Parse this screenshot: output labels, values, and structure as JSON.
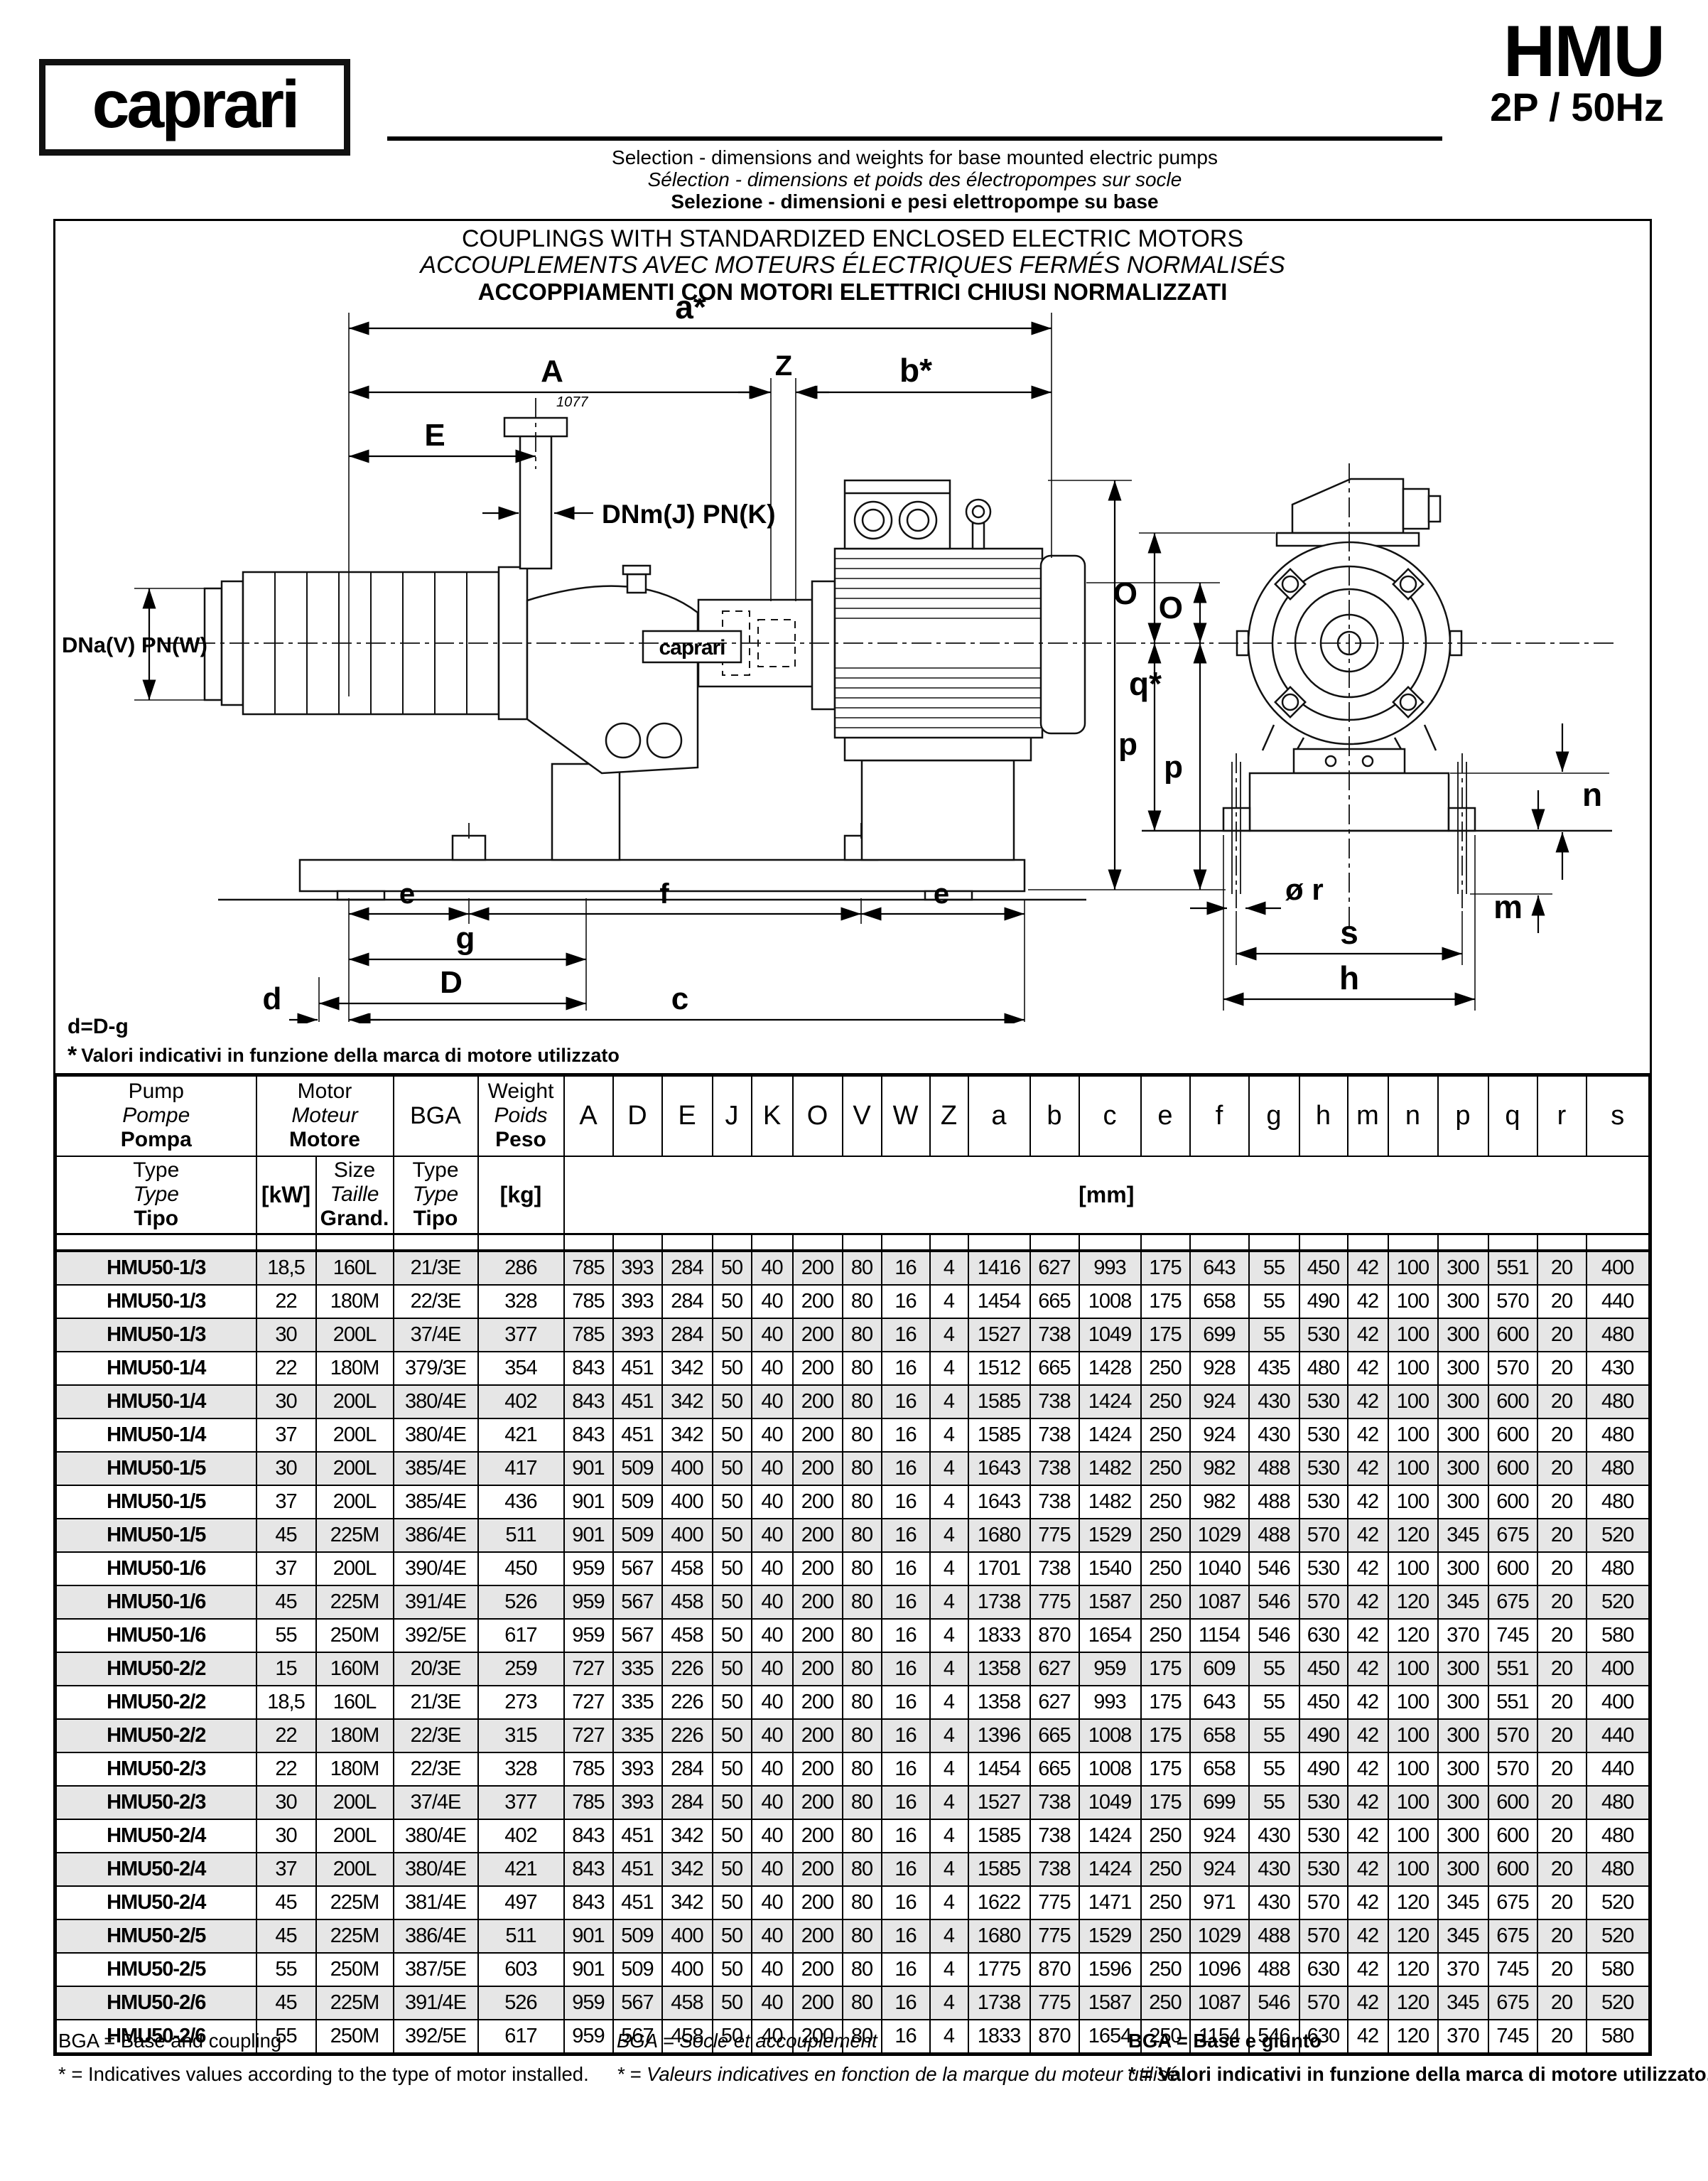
{
  "header": {
    "logo": "caprari",
    "title": "HMU",
    "subtitle": "2P / 50Hz",
    "line_en": "Selection - dimensions and weights for base mounted electric pumps",
    "line_fr": "Sélection - dimensions et poids des électropompes sur socle",
    "line_it": "Selezione - dimensioni e pesi elettropompe su base"
  },
  "box_titles": {
    "en": "COUPLINGS WITH STANDARDIZED ENCLOSED ELECTRIC MOTORS",
    "fr": "ACCOUPLEMENTS AVEC MOTEURS ÉLECTRIQUES FERMÉS NORMALISÉS",
    "it": "ACCOPPIAMENTI CON MOTORI ELETTRICI CHIUSI NORMALIZZATI"
  },
  "drawing": {
    "labels": {
      "a_star": "a*",
      "A": "A",
      "Z": "Z",
      "b_star": "b*",
      "E": "E",
      "dnm": "DNm(J) PN(K)",
      "dna": "DNa(V) PN(W)",
      "q_star": "q*",
      "O_side": "O",
      "p_side": "p",
      "e1": "e",
      "f": "f",
      "e2": "e",
      "g": "g",
      "D": "D",
      "d": "d",
      "c": "c",
      "O_end": "O",
      "p_end": "p",
      "n": "n",
      "m": "m",
      "r": "ø r",
      "s": "s",
      "h": "h",
      "brand": "caprari",
      "serial": "1077"
    },
    "notes": {
      "formula": "d=D-g",
      "star": "*",
      "note_it": "Valori indicativi in funzione della marca di motore utilizzato",
      "note_en": "Indicative values according to the type of motor installed"
    }
  },
  "table": {
    "header": {
      "pump": [
        "Pump",
        "Pompe",
        "Pompa"
      ],
      "motor": [
        "Motor",
        "Moteur",
        "Motore"
      ],
      "bga": "BGA",
      "weight": [
        "Weight",
        "Poids",
        "Peso"
      ],
      "pump_sub": [
        "Type",
        "Type",
        "Tipo"
      ],
      "kw": "[kW]",
      "size_sub": [
        "Size",
        "Taille",
        "Grand."
      ],
      "bga_sub": [
        "Type",
        "Type",
        "Tipo"
      ],
      "kg": "[kg]",
      "mm": "[mm]",
      "dim_cols": [
        "A",
        "D",
        "E",
        "J",
        "K",
        "O",
        "V",
        "W",
        "Z",
        "a",
        "b",
        "c",
        "e",
        "f",
        "g",
        "h",
        "m",
        "n",
        "p",
        "q",
        "r",
        "s"
      ]
    },
    "rows": [
      {
        "type": "HMU50-1/3",
        "kw": "18,5",
        "size": "160L",
        "bga": "21/3E",
        "kg": "286",
        "dims": [
          785,
          393,
          284,
          50,
          40,
          200,
          80,
          16,
          4,
          1416,
          627,
          993,
          175,
          643,
          55,
          450,
          42,
          100,
          300,
          551,
          20,
          400
        ]
      },
      {
        "type": "HMU50-1/3",
        "kw": "22",
        "size": "180M",
        "bga": "22/3E",
        "kg": "328",
        "dims": [
          785,
          393,
          284,
          50,
          40,
          200,
          80,
          16,
          4,
          1454,
          665,
          1008,
          175,
          658,
          55,
          490,
          42,
          100,
          300,
          570,
          20,
          440
        ]
      },
      {
        "type": "HMU50-1/3",
        "kw": "30",
        "size": "200L",
        "bga": "37/4E",
        "kg": "377",
        "dims": [
          785,
          393,
          284,
          50,
          40,
          200,
          80,
          16,
          4,
          1527,
          738,
          1049,
          175,
          699,
          55,
          530,
          42,
          100,
          300,
          600,
          20,
          480
        ]
      },
      {
        "type": "HMU50-1/4",
        "kw": "22",
        "size": "180M",
        "bga": "379/3E",
        "kg": "354",
        "dims": [
          843,
          451,
          342,
          50,
          40,
          200,
          80,
          16,
          4,
          1512,
          665,
          1428,
          250,
          928,
          435,
          480,
          42,
          100,
          300,
          570,
          20,
          430
        ]
      },
      {
        "type": "HMU50-1/4",
        "kw": "30",
        "size": "200L",
        "bga": "380/4E",
        "kg": "402",
        "dims": [
          843,
          451,
          342,
          50,
          40,
          200,
          80,
          16,
          4,
          1585,
          738,
          1424,
          250,
          924,
          430,
          530,
          42,
          100,
          300,
          600,
          20,
          480
        ]
      },
      {
        "type": "HMU50-1/4",
        "kw": "37",
        "size": "200L",
        "bga": "380/4E",
        "kg": "421",
        "dims": [
          843,
          451,
          342,
          50,
          40,
          200,
          80,
          16,
          4,
          1585,
          738,
          1424,
          250,
          924,
          430,
          530,
          42,
          100,
          300,
          600,
          20,
          480
        ]
      },
      {
        "type": "HMU50-1/5",
        "kw": "30",
        "size": "200L",
        "bga": "385/4E",
        "kg": "417",
        "dims": [
          901,
          509,
          400,
          50,
          40,
          200,
          80,
          16,
          4,
          1643,
          738,
          1482,
          250,
          982,
          488,
          530,
          42,
          100,
          300,
          600,
          20,
          480
        ]
      },
      {
        "type": "HMU50-1/5",
        "kw": "37",
        "size": "200L",
        "bga": "385/4E",
        "kg": "436",
        "dims": [
          901,
          509,
          400,
          50,
          40,
          200,
          80,
          16,
          4,
          1643,
          738,
          1482,
          250,
          982,
          488,
          530,
          42,
          100,
          300,
          600,
          20,
          480
        ]
      },
      {
        "type": "HMU50-1/5",
        "kw": "45",
        "size": "225M",
        "bga": "386/4E",
        "kg": "511",
        "dims": [
          901,
          509,
          400,
          50,
          40,
          200,
          80,
          16,
          4,
          1680,
          775,
          1529,
          250,
          1029,
          488,
          570,
          42,
          120,
          345,
          675,
          20,
          520
        ]
      },
      {
        "type": "HMU50-1/6",
        "kw": "37",
        "size": "200L",
        "bga": "390/4E",
        "kg": "450",
        "dims": [
          959,
          567,
          458,
          50,
          40,
          200,
          80,
          16,
          4,
          1701,
          738,
          1540,
          250,
          1040,
          546,
          530,
          42,
          100,
          300,
          600,
          20,
          480
        ]
      },
      {
        "type": "HMU50-1/6",
        "kw": "45",
        "size": "225M",
        "bga": "391/4E",
        "kg": "526",
        "dims": [
          959,
          567,
          458,
          50,
          40,
          200,
          80,
          16,
          4,
          1738,
          775,
          1587,
          250,
          1087,
          546,
          570,
          42,
          120,
          345,
          675,
          20,
          520
        ]
      },
      {
        "type": "HMU50-1/6",
        "kw": "55",
        "size": "250M",
        "bga": "392/5E",
        "kg": "617",
        "dims": [
          959,
          567,
          458,
          50,
          40,
          200,
          80,
          16,
          4,
          1833,
          870,
          1654,
          250,
          1154,
          546,
          630,
          42,
          120,
          370,
          745,
          20,
          580
        ]
      },
      {
        "type": "HMU50-2/2",
        "kw": "15",
        "size": "160M",
        "bga": "20/3E",
        "kg": "259",
        "dims": [
          727,
          335,
          226,
          50,
          40,
          200,
          80,
          16,
          4,
          1358,
          627,
          959,
          175,
          609,
          55,
          450,
          42,
          100,
          300,
          551,
          20,
          400
        ]
      },
      {
        "type": "HMU50-2/2",
        "kw": "18,5",
        "size": "160L",
        "bga": "21/3E",
        "kg": "273",
        "dims": [
          727,
          335,
          226,
          50,
          40,
          200,
          80,
          16,
          4,
          1358,
          627,
          993,
          175,
          643,
          55,
          450,
          42,
          100,
          300,
          551,
          20,
          400
        ]
      },
      {
        "type": "HMU50-2/2",
        "kw": "22",
        "size": "180M",
        "bga": "22/3E",
        "kg": "315",
        "dims": [
          727,
          335,
          226,
          50,
          40,
          200,
          80,
          16,
          4,
          1396,
          665,
          1008,
          175,
          658,
          55,
          490,
          42,
          100,
          300,
          570,
          20,
          440
        ]
      },
      {
        "type": "HMU50-2/3",
        "kw": "22",
        "size": "180M",
        "bga": "22/3E",
        "kg": "328",
        "dims": [
          785,
          393,
          284,
          50,
          40,
          200,
          80,
          16,
          4,
          1454,
          665,
          1008,
          175,
          658,
          55,
          490,
          42,
          100,
          300,
          570,
          20,
          440
        ]
      },
      {
        "type": "HMU50-2/3",
        "kw": "30",
        "size": "200L",
        "bga": "37/4E",
        "kg": "377",
        "dims": [
          785,
          393,
          284,
          50,
          40,
          200,
          80,
          16,
          4,
          1527,
          738,
          1049,
          175,
          699,
          55,
          530,
          42,
          100,
          300,
          600,
          20,
          480
        ]
      },
      {
        "type": "HMU50-2/4",
        "kw": "30",
        "size": "200L",
        "bga": "380/4E",
        "kg": "402",
        "dims": [
          843,
          451,
          342,
          50,
          40,
          200,
          80,
          16,
          4,
          1585,
          738,
          1424,
          250,
          924,
          430,
          530,
          42,
          100,
          300,
          600,
          20,
          480
        ]
      },
      {
        "type": "HMU50-2/4",
        "kw": "37",
        "size": "200L",
        "bga": "380/4E",
        "kg": "421",
        "dims": [
          843,
          451,
          342,
          50,
          40,
          200,
          80,
          16,
          4,
          1585,
          738,
          1424,
          250,
          924,
          430,
          530,
          42,
          100,
          300,
          600,
          20,
          480
        ]
      },
      {
        "type": "HMU50-2/4",
        "kw": "45",
        "size": "225M",
        "bga": "381/4E",
        "kg": "497",
        "dims": [
          843,
          451,
          342,
          50,
          40,
          200,
          80,
          16,
          4,
          1622,
          775,
          1471,
          250,
          971,
          430,
          570,
          42,
          120,
          345,
          675,
          20,
          520
        ]
      },
      {
        "type": "HMU50-2/5",
        "kw": "45",
        "size": "225M",
        "bga": "386/4E",
        "kg": "511",
        "dims": [
          901,
          509,
          400,
          50,
          40,
          200,
          80,
          16,
          4,
          1680,
          775,
          1529,
          250,
          1029,
          488,
          570,
          42,
          120,
          345,
          675,
          20,
          520
        ]
      },
      {
        "type": "HMU50-2/5",
        "kw": "55",
        "size": "250M",
        "bga": "387/5E",
        "kg": "603",
        "dims": [
          901,
          509,
          400,
          50,
          40,
          200,
          80,
          16,
          4,
          1775,
          870,
          1596,
          250,
          1096,
          488,
          630,
          42,
          120,
          370,
          745,
          20,
          580
        ]
      },
      {
        "type": "HMU50-2/6",
        "kw": "45",
        "size": "225M",
        "bga": "391/4E",
        "kg": "526",
        "dims": [
          959,
          567,
          458,
          50,
          40,
          200,
          80,
          16,
          4,
          1738,
          775,
          1587,
          250,
          1087,
          546,
          570,
          42,
          120,
          345,
          675,
          20,
          520
        ]
      },
      {
        "type": "HMU50-2/6",
        "kw": "55",
        "size": "250M",
        "bga": "392/5E",
        "kg": "617",
        "dims": [
          959,
          567,
          458,
          50,
          40,
          200,
          80,
          16,
          4,
          1833,
          870,
          1654,
          250,
          1154,
          546,
          630,
          42,
          120,
          370,
          745,
          20,
          580
        ]
      }
    ]
  },
  "footer": {
    "en_bga": "BGA = Base and coupling",
    "en_note": "* = Indicatives values according to the type of motor installed.",
    "fr_bga": "BGA = Socle et accouplement",
    "fr_note": "* = Valeurs indicatives en fonction de la marque du moteur utilisé.",
    "it_bga": "BGA = Base e giunto",
    "it_note": "* = Valori indicativi in funzione della marca di motore utilizzato."
  }
}
